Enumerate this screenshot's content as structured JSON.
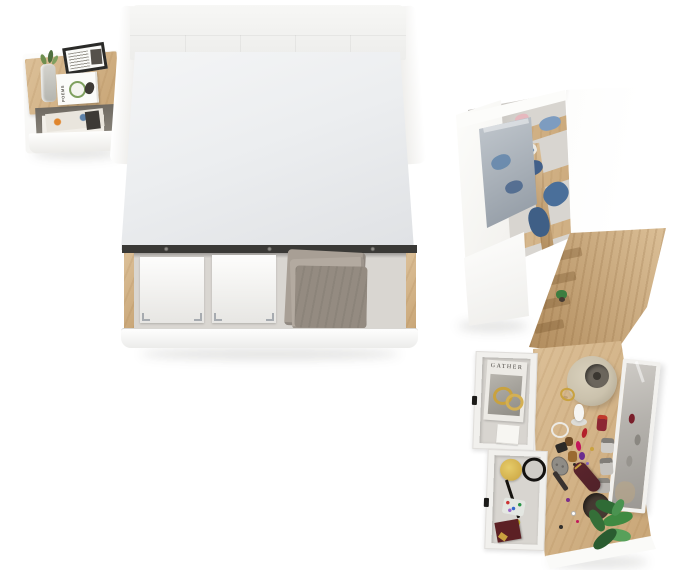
{
  "furniture": {
    "nightstand": {
      "label": "nightstand with open magazine shelf",
      "book_title": "POEMS",
      "items": [
        "glass-vase-with-greenery",
        "framed-print",
        "poetry-book",
        "magazines"
      ]
    },
    "bed": {
      "label": "double bed with open storage drawer",
      "items": [
        "upholstered-headboard",
        "mattress",
        "storage-box",
        "storage-box",
        "folded-blanket"
      ]
    },
    "wardrobe": {
      "label": "open wardrobe with folded denim clothes",
      "items": [
        "mirror-door",
        "folded-jeans",
        "hanging-denim-jacket",
        "shelf-plant"
      ]
    },
    "vanity": {
      "label": "dressing table with mirror and open drawers",
      "magazine_title": "GATHER",
      "items": [
        "table-lamp",
        "standing-mirror",
        "bunny-figurine",
        "perfume-bottles",
        "lipsticks",
        "hairbrush",
        "clutch-bag",
        "potted-plant",
        "gold-bangles",
        "powder-box",
        "hand-mirror",
        "eyeliner-pencil",
        "bead-pouch"
      ]
    }
  },
  "palette": {
    "white": "#fdfdfc",
    "wood": "#dcc098",
    "wood_dark": "#c8a576",
    "wood_deep": "#b08b5c",
    "mattress": "#eceef0",
    "mattress_dark": "#dfe1e4",
    "headboard": "#f7f7f5",
    "rail": "#3a3936",
    "drawer_floor": "#d9d6d1",
    "blanket": "#a89f95",
    "blanket_dark": "#948b81",
    "interior": "#d8d5d0",
    "denim": "#5d82aa",
    "denim_dark": "#42608a",
    "denim_light": "#7d9cc0",
    "pink": "#e6b8be",
    "gray_shelf": "#8a8580",
    "mirror_hi": "#c3c9cf",
    "mirror_lo": "#8f98a2",
    "lamp": "#cbc2ad",
    "lamp_dark": "#a89f8a",
    "lamp_hole": "#6b655c",
    "plant": "#3c7d40",
    "plant_dark": "#2a5c30",
    "pot": "#453a32",
    "clutch": "#512229",
    "gold": "#c9a23f"
  }
}
